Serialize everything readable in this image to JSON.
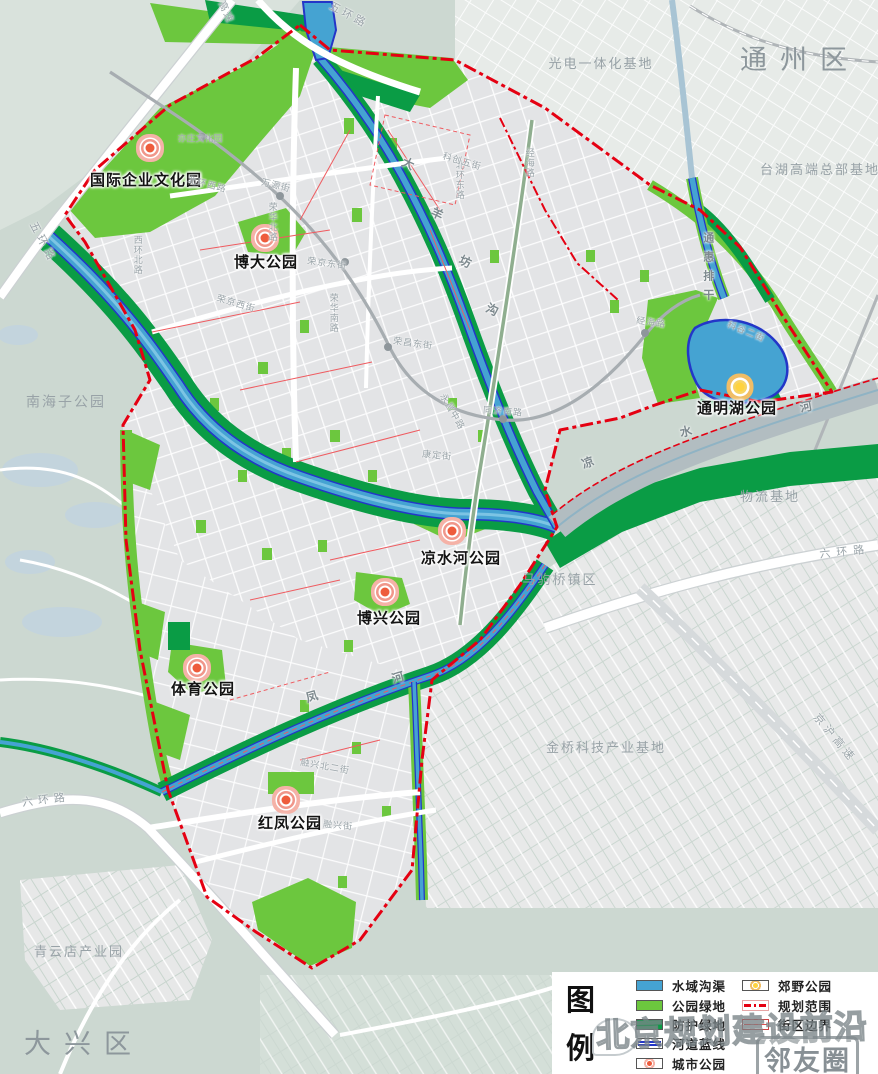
{
  "colors": {
    "water": "#45a3d2",
    "water_edge": "#2336c8",
    "park_green": "#6cc73e",
    "shelter_green": "#0a9c45",
    "boundary_red": "#e50012",
    "block_red": "#ef5b60",
    "urban_gray": "#e3e4e6",
    "rural_sage": "#ccd8d1",
    "river_gray": "#b2bdc1",
    "marker_city": "#ee5c3c",
    "marker_country": "#ffd33e",
    "label_gray": "#98a2a7"
  },
  "map": {
    "labels": [
      {
        "t": "通州区",
        "x": 800,
        "y": 60,
        "c": "district",
        "n": "district-label-tongzhou"
      },
      {
        "t": "大兴区",
        "x": 84,
        "y": 1044,
        "c": "district",
        "n": "district-label-daxing"
      },
      {
        "t": "光电一体化基地",
        "x": 601,
        "y": 64,
        "c": "area",
        "n": "area-label-optoelectronics-base"
      },
      {
        "t": "台湖高端总部基地",
        "x": 820,
        "y": 170,
        "c": "area",
        "n": "area-label-taihu-hq-base"
      },
      {
        "t": "南海子公园",
        "x": 66,
        "y": 402,
        "c": "area",
        "s": 14,
        "n": "area-label-nanhaizi-park"
      },
      {
        "t": "物流基地",
        "x": 770,
        "y": 497,
        "c": "area",
        "n": "area-label-logistics-base"
      },
      {
        "t": "马驹桥镇区",
        "x": 560,
        "y": 580,
        "c": "area",
        "n": "area-label-majuqiao-town"
      },
      {
        "t": "金桥科技产业基地",
        "x": 606,
        "y": 748,
        "c": "area",
        "n": "area-label-jinqiao-tech-base"
      },
      {
        "t": "青云店产业园",
        "x": 79,
        "y": 952,
        "c": "area",
        "n": "area-label-qingyundian-park"
      },
      {
        "t": "国际企业文化园",
        "x": 146,
        "y": 181,
        "c": "park",
        "n": "park-label-intl-enterprise-culture"
      },
      {
        "t": "博大公园",
        "x": 266,
        "y": 263,
        "c": "park",
        "n": "park-label-boda"
      },
      {
        "t": "凉水河公园",
        "x": 461,
        "y": 559,
        "c": "park",
        "n": "park-label-liangshuihe"
      },
      {
        "t": "博兴公园",
        "x": 389,
        "y": 619,
        "c": "park",
        "n": "park-label-boxing"
      },
      {
        "t": "体育公园",
        "x": 203,
        "y": 690,
        "c": "park",
        "n": "park-label-sports"
      },
      {
        "t": "红凤公园",
        "x": 290,
        "y": 824,
        "c": "park",
        "n": "park-label-hongfeng"
      },
      {
        "t": "通明湖公园",
        "x": 737,
        "y": 409,
        "c": "park",
        "n": "park-label-tongminghu"
      },
      {
        "t": "五环路",
        "x": 42,
        "y": 243,
        "c": "road",
        "r": 62,
        "s": 11,
        "ls": 4,
        "n": "road-label-5th-ring-w"
      },
      {
        "t": "五环路",
        "x": 348,
        "y": 16,
        "c": "road",
        "r": 28,
        "s": 11,
        "ls": 3,
        "n": "road-label-5th-ring-n"
      },
      {
        "t": "高速",
        "x": 225,
        "y": 13,
        "c": "road",
        "r": 65,
        "s": 10,
        "ls": 2,
        "n": "road-label-expressway-n"
      },
      {
        "t": "六环路",
        "x": 46,
        "y": 801,
        "c": "road",
        "r": -7,
        "s": 11,
        "ls": 5,
        "n": "road-label-6th-ring-sw"
      },
      {
        "t": "六环路",
        "x": 845,
        "y": 553,
        "c": "road",
        "r": -6,
        "s": 11,
        "ls": 6,
        "n": "road-label-6th-ring-e"
      },
      {
        "t": "京沪高速",
        "x": 834,
        "y": 739,
        "c": "road",
        "r": 50,
        "s": 11,
        "ls": 4,
        "n": "road-label-jinghu-expwy"
      },
      {
        "t": "北环东路",
        "x": 459,
        "y": 180,
        "c": "road",
        "v": 1,
        "s": 9,
        "n": "road-label-beihuan-east"
      },
      {
        "t": "北环西路",
        "x": 207,
        "y": 185,
        "c": "road",
        "r": 14,
        "s": 9,
        "n": "road-label-beihuan-west"
      },
      {
        "t": "万源街",
        "x": 276,
        "y": 186,
        "c": "road",
        "r": 14,
        "s": 9,
        "n": "road-label-wanyuan-st"
      },
      {
        "t": "西环北路",
        "x": 137,
        "y": 255,
        "c": "road",
        "v": 1,
        "s": 9,
        "n": "road-label-xihuan-north"
      },
      {
        "t": "荣华北路",
        "x": 272,
        "y": 222,
        "c": "road",
        "v": 1,
        "s": 9,
        "n": "road-label-ronghua-north"
      },
      {
        "t": "荣京东街",
        "x": 327,
        "y": 264,
        "c": "road",
        "r": 8,
        "s": 9,
        "n": "road-label-rongjing-east"
      },
      {
        "t": "荣京西街",
        "x": 236,
        "y": 304,
        "c": "road",
        "r": 16,
        "s": 9,
        "n": "road-label-rongjing-west"
      },
      {
        "t": "荣华南路",
        "x": 333,
        "y": 313,
        "c": "road",
        "v": 1,
        "s": 9,
        "n": "road-label-ronghua-south"
      },
      {
        "t": "荣昌东街",
        "x": 413,
        "y": 344,
        "c": "road",
        "r": 8,
        "s": 9,
        "n": "road-label-rongchang-east"
      },
      {
        "t": "永昌中路",
        "x": 452,
        "y": 412,
        "c": "road",
        "r": 60,
        "s": 9,
        "n": "road-label-yongchang-mid"
      },
      {
        "t": "同济南路",
        "x": 503,
        "y": 412,
        "c": "road",
        "r": 4,
        "s": 9,
        "n": "road-label-tongji-south"
      },
      {
        "t": "康定街",
        "x": 437,
        "y": 456,
        "c": "road",
        "r": 6,
        "s": 9,
        "n": "road-label-kangding-st"
      },
      {
        "t": "经海路",
        "x": 529,
        "y": 163,
        "c": "road",
        "v": 1,
        "s": 9,
        "n": "road-label-jinghai-n"
      },
      {
        "t": "经海路",
        "x": 651,
        "y": 323,
        "c": "road",
        "r": 8,
        "s": 9,
        "n": "road-label-jinghai-s"
      },
      {
        "t": "科创五街",
        "x": 462,
        "y": 162,
        "c": "road",
        "r": 16,
        "s": 9,
        "n": "road-label-kechuang-5th"
      },
      {
        "t": "科谷二街",
        "x": 746,
        "y": 332,
        "c": "road",
        "r": 22,
        "s": 9,
        "n": "road-label-kegu-2nd"
      },
      {
        "t": "融兴北二街",
        "x": 325,
        "y": 767,
        "c": "road",
        "r": 10,
        "s": 9,
        "n": "road-label-rongxing-n2"
      },
      {
        "t": "融兴街",
        "x": 338,
        "y": 826,
        "c": "road",
        "r": 6,
        "s": 9,
        "n": "road-label-rongxing-st"
      },
      {
        "t": "亦庄文化园",
        "x": 200,
        "y": 139,
        "c": "station",
        "n": "station-label-yizhuang-culture-park"
      },
      {
        "t": "凉",
        "x": 588,
        "y": 463,
        "c": "river",
        "r": -20,
        "n": "river-label-liangshuihe-1"
      },
      {
        "t": "水",
        "x": 686,
        "y": 432,
        "c": "river",
        "r": -12,
        "n": "river-label-liangshuihe-2"
      },
      {
        "t": "河",
        "x": 806,
        "y": 407,
        "c": "river",
        "r": -10,
        "n": "river-label-liangshuihe-3"
      },
      {
        "t": "大",
        "x": 408,
        "y": 164,
        "c": "river",
        "r": 25,
        "n": "river-label-dayangfang-1"
      },
      {
        "t": "羊",
        "x": 437,
        "y": 214,
        "c": "river",
        "r": 25,
        "n": "river-label-dayangfang-2"
      },
      {
        "t": "坊",
        "x": 465,
        "y": 262,
        "c": "river",
        "r": 25,
        "n": "river-label-dayangfang-3"
      },
      {
        "t": "沟",
        "x": 492,
        "y": 310,
        "c": "river",
        "r": 25,
        "n": "river-label-dayangfang-4"
      },
      {
        "t": "通惠排干",
        "x": 707,
        "y": 270,
        "c": "river",
        "v": 1,
        "s": 11,
        "ls": 8,
        "n": "river-label-tonghui-canal"
      },
      {
        "t": "凤",
        "x": 312,
        "y": 697,
        "c": "river",
        "r": -16,
        "n": "river-label-fenghe-1"
      },
      {
        "t": "河",
        "x": 398,
        "y": 678,
        "c": "river",
        "r": -16,
        "n": "river-label-fenghe-2"
      }
    ],
    "park_markers": [
      {
        "x": 150,
        "y": 148,
        "k": "city",
        "n": "intl-enterprise-culture-park"
      },
      {
        "x": 265,
        "y": 238,
        "k": "city",
        "n": "boda-park"
      },
      {
        "x": 452,
        "y": 531,
        "k": "city",
        "n": "liangshuihe-park"
      },
      {
        "x": 385,
        "y": 592,
        "k": "city",
        "n": "boxing-park"
      },
      {
        "x": 197,
        "y": 668,
        "k": "city",
        "n": "sports-park"
      },
      {
        "x": 286,
        "y": 800,
        "k": "city",
        "n": "hongfeng-park"
      },
      {
        "x": 740,
        "y": 387,
        "k": "country",
        "n": "tongminghu-park"
      }
    ]
  },
  "legend": {
    "title": "图例",
    "items_left": [
      {
        "label": "水域沟渠",
        "swatch": "water"
      },
      {
        "label": "公园绿地",
        "swatch": "park-green"
      },
      {
        "label": "防护绿地",
        "swatch": "shelter-green"
      },
      {
        "label": "河道蓝线",
        "swatch": "blue-line"
      },
      {
        "label": "城市公园",
        "swatch": "city-park"
      }
    ],
    "items_right": [
      {
        "label": "郊野公园",
        "swatch": "country-park"
      },
      {
        "label": "规划范围",
        "swatch": "plan-boundary"
      },
      {
        "label": "街区边界",
        "swatch": "block-boundary"
      }
    ]
  },
  "watermark": {
    "text": "北京规划建设前沿",
    "badge": "邻友圈"
  }
}
